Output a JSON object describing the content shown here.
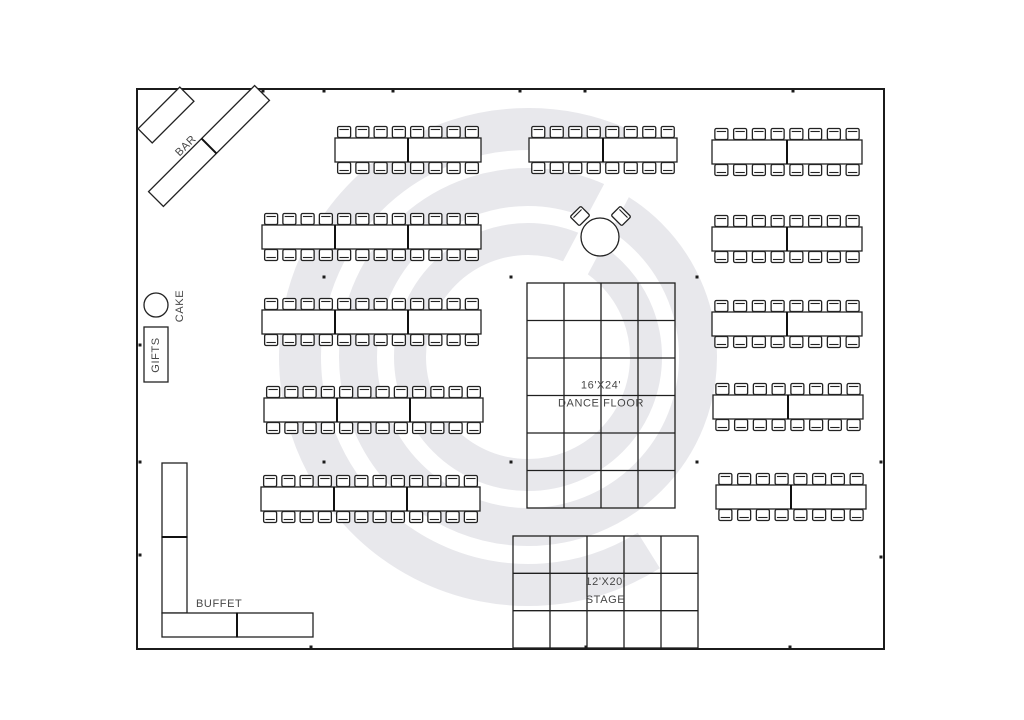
{
  "plan": {
    "colors": {
      "background": "#ffffff",
      "line": "#222222",
      "text": "#474747",
      "watermark": "#e8e8ec"
    },
    "room": {
      "x": 137,
      "y": 89,
      "width": 747,
      "height": 560
    },
    "watermark": {
      "cx": 528,
      "cy": 357,
      "outer_r": 228,
      "outer_stroke": 42,
      "outer_start_deg": 65,
      "outer_end_deg": -58,
      "mid_r": 170,
      "mid_stroke": 38,
      "inner_r": 118,
      "inner_stroke": 32,
      "slit_angle": -62,
      "slit_inner": 55,
      "slit_length": 360,
      "slit_width": 28
    },
    "bar": {
      "label": "BAR",
      "label_pos": {
        "x": 186,
        "y": 146,
        "rotation": -45
      },
      "tables": [
        {
          "cx": 166,
          "cy": 115,
          "length": 59,
          "width": 20,
          "rotation": -45,
          "segments": 1
        },
        {
          "cx": 209,
          "cy": 146,
          "length": 150,
          "width": 21,
          "rotation": -45,
          "segments": 2
        }
      ]
    },
    "cake": {
      "label": "CAKE",
      "cx": 156,
      "cy": 305,
      "r": 12,
      "label_pos": {
        "x": 180,
        "y": 306,
        "rotation": -90
      }
    },
    "gifts": {
      "label": "GIFTS",
      "x": 144,
      "y": 327,
      "width": 24,
      "height": 55,
      "label_pos": {
        "x": 156,
        "y": 355,
        "rotation": -90
      }
    },
    "buffet": {
      "label": "BUFFET",
      "label_pos": {
        "x": 196,
        "y": 607
      },
      "tables": [
        {
          "x": 162,
          "y": 463,
          "width": 25,
          "height": 74
        },
        {
          "x": 162,
          "y": 537,
          "width": 25,
          "height": 76
        },
        {
          "x": 162,
          "y": 613,
          "width": 75,
          "height": 24
        },
        {
          "x": 237,
          "y": 613,
          "width": 76,
          "height": 24
        }
      ],
      "dividers": [
        {
          "x1": 162,
          "y1": 537,
          "x2": 187,
          "y2": 537
        },
        {
          "x1": 237,
          "y1": 613,
          "x2": 237,
          "y2": 637
        }
      ]
    },
    "sweetheart_table": {
      "cx": 600,
      "cy": 237,
      "r": 19,
      "chairs": [
        {
          "cx": 580,
          "cy": 216,
          "rotation": -45
        },
        {
          "cx": 621,
          "cy": 216,
          "rotation": 45
        }
      ],
      "chair_size": {
        "width": 15,
        "height": 13
      }
    },
    "dance_floor": {
      "size_label": "16'X24'",
      "name_label": "DANCE FLOOR",
      "x": 527,
      "y": 283,
      "width": 148,
      "height": 225,
      "cols": 4,
      "rows": 6
    },
    "stage": {
      "size_label": "12'X20'",
      "name_label": "STAGE",
      "x": 513,
      "y": 536,
      "width": 185,
      "height": 112,
      "cols": 5,
      "rows": 3
    },
    "table_height": 24,
    "chair": {
      "width": 13,
      "height": 11,
      "per_segment_side": 4
    },
    "banquet_tables": [
      {
        "x": 335,
        "y": 138,
        "width": 146,
        "segments": 2,
        "seats": 16
      },
      {
        "x": 262,
        "y": 225,
        "width": 219,
        "segments": 3,
        "seats": 24
      },
      {
        "x": 262,
        "y": 310,
        "width": 219,
        "segments": 3,
        "seats": 24
      },
      {
        "x": 264,
        "y": 398,
        "width": 219,
        "segments": 3,
        "seats": 24
      },
      {
        "x": 261,
        "y": 487,
        "width": 219,
        "segments": 3,
        "seats": 24
      },
      {
        "x": 529,
        "y": 138,
        "width": 148,
        "segments": 2,
        "seats": 16
      },
      {
        "x": 712,
        "y": 140,
        "width": 150,
        "segments": 2,
        "seats": 16
      },
      {
        "x": 712,
        "y": 227,
        "width": 150,
        "segments": 2,
        "seats": 16
      },
      {
        "x": 712,
        "y": 312,
        "width": 150,
        "segments": 2,
        "seats": 16
      },
      {
        "x": 713,
        "y": 395,
        "width": 150,
        "segments": 2,
        "seats": 16
      },
      {
        "x": 716,
        "y": 485,
        "width": 150,
        "segments": 2,
        "seats": 16
      }
    ],
    "pole_dots": [
      {
        "x": 263,
        "y": 91
      },
      {
        "x": 324,
        "y": 91
      },
      {
        "x": 393,
        "y": 91
      },
      {
        "x": 520,
        "y": 91
      },
      {
        "x": 585,
        "y": 91
      },
      {
        "x": 793,
        "y": 91
      },
      {
        "x": 311,
        "y": 647
      },
      {
        "x": 586,
        "y": 647
      },
      {
        "x": 790,
        "y": 647
      },
      {
        "x": 140,
        "y": 345
      },
      {
        "x": 140,
        "y": 462
      },
      {
        "x": 140,
        "y": 555
      },
      {
        "x": 881,
        "y": 462
      },
      {
        "x": 881,
        "y": 557
      },
      {
        "x": 324,
        "y": 277
      },
      {
        "x": 511,
        "y": 277
      },
      {
        "x": 697,
        "y": 277
      },
      {
        "x": 324,
        "y": 462
      },
      {
        "x": 511,
        "y": 462
      },
      {
        "x": 697,
        "y": 462
      }
    ]
  }
}
